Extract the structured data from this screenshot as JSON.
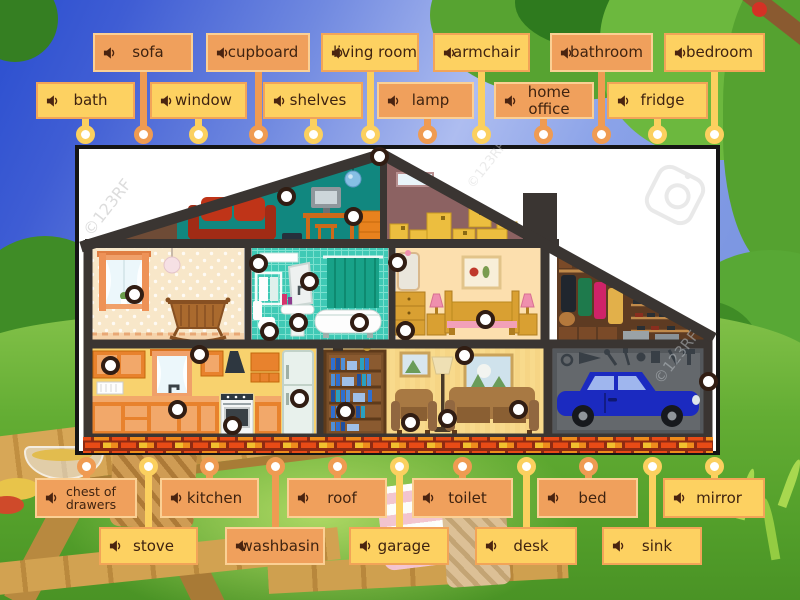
{
  "watermarks": {
    "left": "©123RF",
    "mid": "©123RF",
    "right": "©123RF"
  },
  "colors": {
    "orange": {
      "fill": "#f0a05c",
      "border": "#fbd094",
      "line": "#ef9b52"
    },
    "yellow": {
      "fill": "#fdd161",
      "border": "#f2a458",
      "line": "#fbd05f"
    },
    "label_text": "#3f2310",
    "dot_ring": "#311d13"
  },
  "labels": {
    "top": [
      {
        "text": "sofa",
        "color": "orange",
        "x": 93,
        "w": 100,
        "row": 1,
        "cx": 143
      },
      {
        "text": "cupboard",
        "color": "orange",
        "x": 206,
        "w": 104,
        "row": 1,
        "cx": 258
      },
      {
        "text": "living room",
        "color": "yellow",
        "x": 321,
        "w": 98,
        "row": 1,
        "cx": 370
      },
      {
        "text": "armchair",
        "color": "yellow",
        "x": 433,
        "w": 97,
        "row": 1,
        "cx": 481
      },
      {
        "text": "bathroom",
        "color": "orange",
        "x": 550,
        "w": 103,
        "row": 1,
        "cx": 601
      },
      {
        "text": "bedroom",
        "color": "yellow",
        "x": 664,
        "w": 101,
        "row": 1,
        "cx": 714
      },
      {
        "text": "bath",
        "color": "yellow",
        "x": 36,
        "w": 99,
        "row": 2,
        "cx": 85
      },
      {
        "text": "window",
        "color": "yellow",
        "x": 150,
        "w": 97,
        "row": 2,
        "cx": 198
      },
      {
        "text": "shelves",
        "color": "yellow",
        "x": 263,
        "w": 100,
        "row": 2,
        "cx": 313
      },
      {
        "text": "lamp",
        "color": "orange",
        "x": 377,
        "w": 97,
        "row": 2,
        "cx": 427
      },
      {
        "text": "home office",
        "color": "orange",
        "x": 494,
        "w": 100,
        "row": 2,
        "cx": 543
      },
      {
        "text": "fridge",
        "color": "yellow",
        "x": 607,
        "w": 101,
        "row": 2,
        "cx": 657
      }
    ],
    "bottom": [
      {
        "text": "chest of drawers",
        "color": "orange",
        "x": 35,
        "w": 102,
        "row": 1,
        "cx": 86,
        "small": true
      },
      {
        "text": "kitchen",
        "color": "orange",
        "x": 160,
        "w": 99,
        "row": 1,
        "cx": 209
      },
      {
        "text": "roof",
        "color": "orange",
        "x": 287,
        "w": 100,
        "row": 1,
        "cx": 337
      },
      {
        "text": "toilet",
        "color": "orange",
        "x": 412,
        "w": 101,
        "row": 1,
        "cx": 462
      },
      {
        "text": "bed",
        "color": "orange",
        "x": 537,
        "w": 101,
        "row": 1,
        "cx": 588
      },
      {
        "text": "mirror",
        "color": "yellow",
        "x": 663,
        "w": 102,
        "row": 1,
        "cx": 714
      },
      {
        "text": "stove",
        "color": "yellow",
        "x": 99,
        "w": 99,
        "row": 2,
        "cx": 148
      },
      {
        "text": "washbasin",
        "color": "orange",
        "x": 225,
        "w": 100,
        "row": 2,
        "cx": 275
      },
      {
        "text": "garage",
        "color": "yellow",
        "x": 349,
        "w": 100,
        "row": 2,
        "cx": 399
      },
      {
        "text": "desk",
        "color": "yellow",
        "x": 475,
        "w": 102,
        "row": 2,
        "cx": 526
      },
      {
        "text": "sink",
        "color": "yellow",
        "x": 602,
        "w": 100,
        "row": 2,
        "cx": 652
      }
    ]
  },
  "targets": [
    {
      "x": 379,
      "y": 156
    },
    {
      "x": 286,
      "y": 196
    },
    {
      "x": 353,
      "y": 216
    },
    {
      "x": 134,
      "y": 294
    },
    {
      "x": 258,
      "y": 263
    },
    {
      "x": 309,
      "y": 281
    },
    {
      "x": 298,
      "y": 322
    },
    {
      "x": 269,
      "y": 331
    },
    {
      "x": 359,
      "y": 322
    },
    {
      "x": 397,
      "y": 262
    },
    {
      "x": 405,
      "y": 330
    },
    {
      "x": 485,
      "y": 319
    },
    {
      "x": 110,
      "y": 365
    },
    {
      "x": 199,
      "y": 354
    },
    {
      "x": 177,
      "y": 409
    },
    {
      "x": 232,
      "y": 425
    },
    {
      "x": 299,
      "y": 398
    },
    {
      "x": 345,
      "y": 411
    },
    {
      "x": 464,
      "y": 355
    },
    {
      "x": 410,
      "y": 422
    },
    {
      "x": 447,
      "y": 418
    },
    {
      "x": 518,
      "y": 409
    },
    {
      "x": 708,
      "y": 381
    }
  ]
}
